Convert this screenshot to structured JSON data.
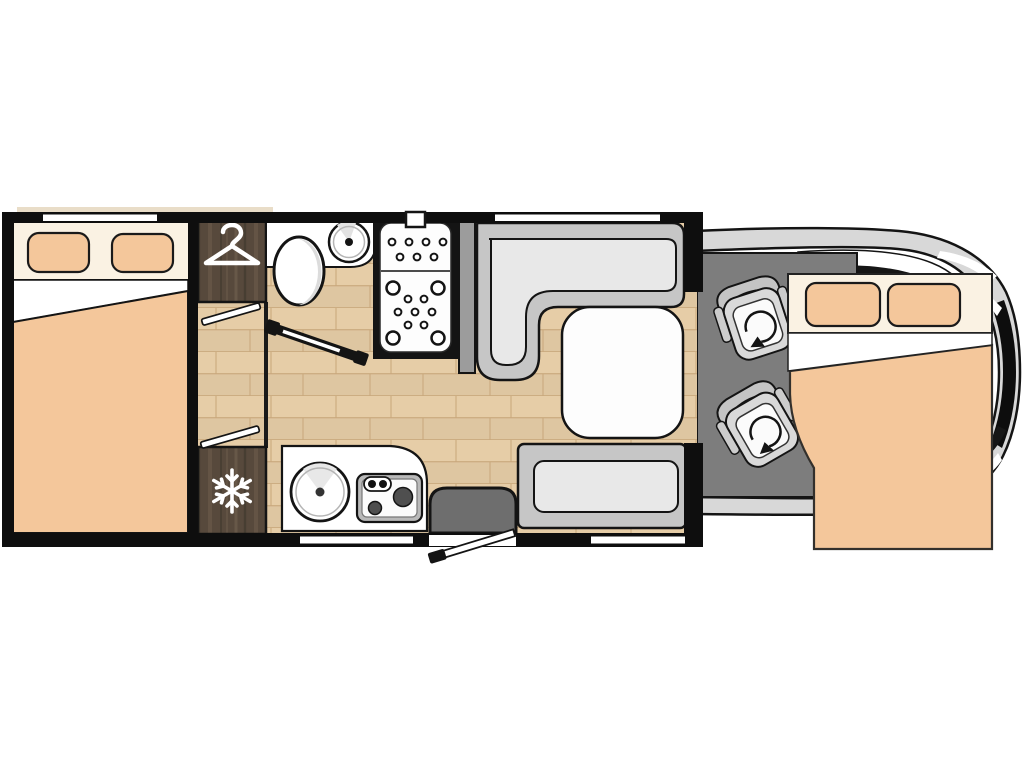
{
  "diagram": {
    "type": "motorhome-floor-plan",
    "title": "Motorhome floor plan, top view",
    "components": {
      "rear_bed": {
        "label": "Rear double bed with two pillows"
      },
      "rear_window": {
        "label": "Rear bedroom window"
      },
      "wardrobe": {
        "label": "Wardrobe",
        "icon": "hanger-icon"
      },
      "sliding_doors": {
        "label": "Bedroom partition doors"
      },
      "bathroom": {
        "label": "Bathroom with toilet and washbasin"
      },
      "toilet": {
        "label": "Toilet"
      },
      "washbasin": {
        "label": "Washbasin"
      },
      "bathroom_door": {
        "label": "Bathroom door"
      },
      "shower": {
        "label": "Shower cubicle with drain tray"
      },
      "fridge": {
        "label": "Refrigerator",
        "icon": "snowflake-icon"
      },
      "kitchen": {
        "label": "Kitchen block with round sink and two-burner hob"
      },
      "kitchen_sink": {
        "label": "Round kitchen sink"
      },
      "hob": {
        "label": "Two-burner hob"
      },
      "dinette_bench": {
        "label": "L-shaped dinette bench"
      },
      "dinette_table": {
        "label": "Dinette table"
      },
      "side_bench": {
        "label": "Side bench seat"
      },
      "entry_step": {
        "label": "Entry step"
      },
      "entry_door": {
        "label": "Entry door, shown open"
      },
      "cab": {
        "label": "Driver cab floor"
      },
      "cab_seats": {
        "label": "Swivel cab seats",
        "icon": "rotation-arrow-icon"
      },
      "vehicle_body": {
        "label": "Vehicle cab body outline with windscreen"
      },
      "drop_down_bed": {
        "label": "Drop-down front double bed with two pillows"
      },
      "windows": {
        "label": "Window opening"
      },
      "awning": {
        "label": "Awning rail"
      }
    },
    "colors": {
      "peach": "#F4C79B",
      "cream": "#FAF2E3",
      "wood": "#E6CDA7",
      "woodline": "#C9A87C",
      "darkwood": "#57493C",
      "darkwoodstreak": "#6E5D4C",
      "darkwoodshadow": "#433A2F",
      "benchback": "#C6C6C6",
      "cushion": "#E8E8E8",
      "cabfloor": "#7D7D7D",
      "body": "#D8D8D8",
      "step": "#6E6E6E",
      "partition": "#9C9C9C",
      "burner": "#4F4F4F",
      "outline": "#141414",
      "white": "#FFFFFF",
      "awning": "#E9DDC8"
    }
  }
}
